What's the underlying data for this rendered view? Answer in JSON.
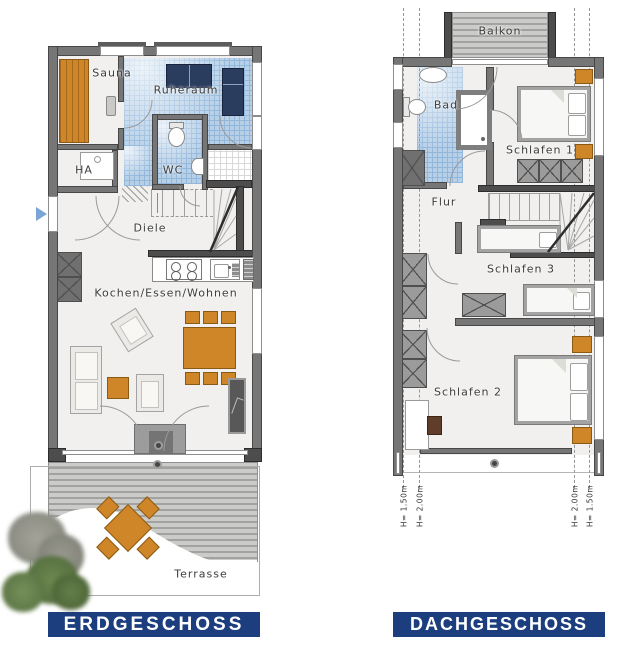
{
  "colors": {
    "title_bg": "#1c3e7e",
    "title_text": "#ffffff",
    "wall": "#767676",
    "wall_dark": "#474747",
    "floor": "#f1f0ee",
    "tile_blue": "#b7d0e8",
    "tile_blue_line": "#93b7da",
    "wood": "#cf8628",
    "wood_dark": "#8a5a14",
    "navy": "#2b3d5e",
    "deck_a": "#cbcbc9",
    "deck_b": "#a2a2a0",
    "label": "#3d3d3d"
  },
  "erdgeschoss": {
    "title": "ERDGESCHOSS",
    "rooms": {
      "sauna": "Sauna",
      "ruheraum": "Ruheraum",
      "ha": "HA",
      "wc": "WC",
      "diele": "Diele",
      "kochen_essen_wohnen": "Kochen/Essen/Wohnen",
      "terrasse": "Terrasse"
    }
  },
  "dachgeschoss": {
    "title": "DACHGESCHOSS",
    "rooms": {
      "balkon": "Balkon",
      "bad": "Bad",
      "flur": "Flur",
      "schlafen1": "Schlafen 1",
      "schlafen3": "Schlafen 3",
      "schlafen2": "Schlafen 2"
    },
    "height_markers": [
      "H= 1.50m",
      "H= 2.00m",
      "H= 2.00m",
      "H= 1.50m"
    ]
  }
}
